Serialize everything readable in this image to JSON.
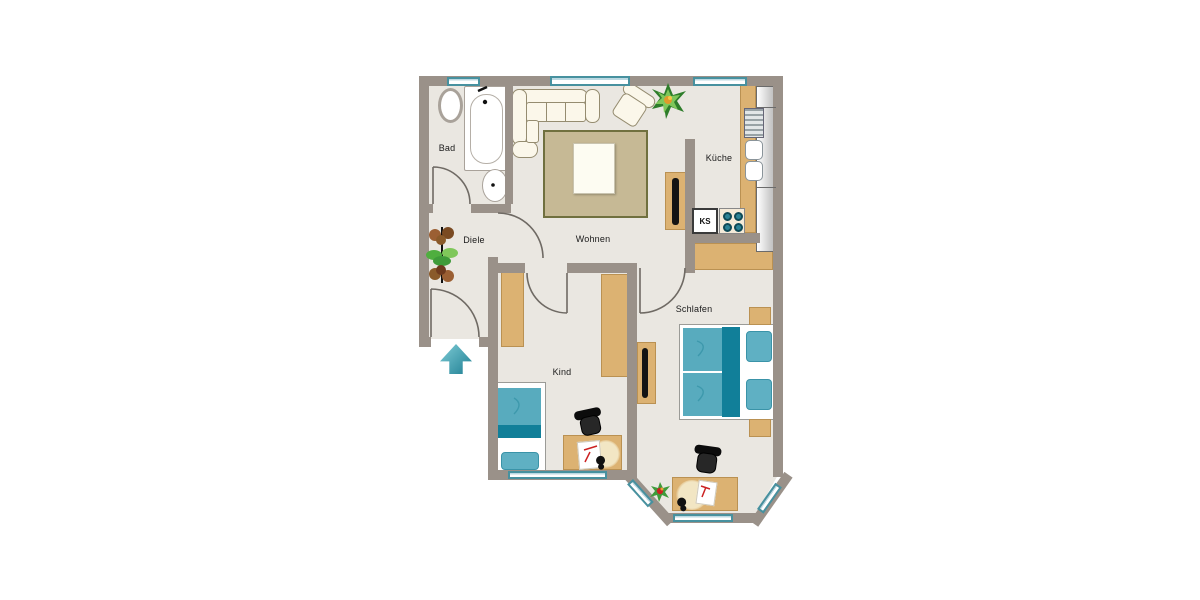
{
  "rooms": {
    "bad": "Bad",
    "diele": "Diele",
    "wohnen": "Wohnen",
    "kueche": "Küche",
    "kind": "Kind",
    "schlafen": "Schlafen"
  },
  "fridge_label": "KS",
  "icons": {
    "entrance": "up-arrow"
  },
  "colors": {
    "wall": "#9a9189",
    "floor": "#eae7e1",
    "furniture_tan": "#dcb272",
    "teal_dark": "#117f99",
    "teal_mid": "#58abbe",
    "window_frame": "#47919f",
    "rug": "#c6b995",
    "entrance_arrow": "#1f7f93"
  }
}
